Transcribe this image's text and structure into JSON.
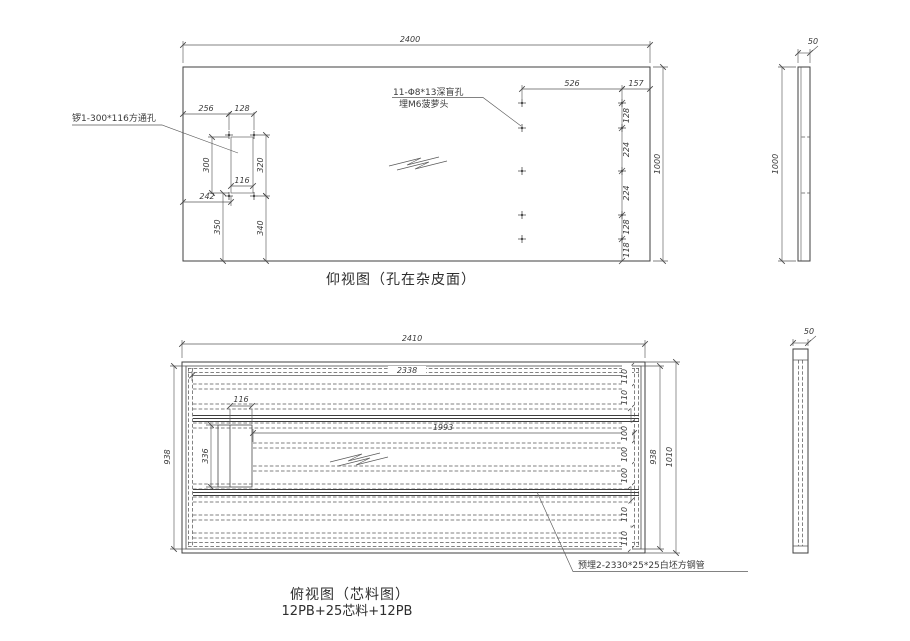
{
  "top_view": {
    "caption": "仰视图（孔在杂皮面）",
    "note_square_hole": "锣1-300*116方通孔",
    "note_holes_1": "11-Φ8*13深盲孔",
    "note_holes_2": "埋M6菠萝头",
    "dim_overall_width": "2400",
    "dim_overall_height": "1000",
    "dim_256": "256",
    "dim_128": "128",
    "dim_300": "300",
    "dim_320": "320",
    "dim_116": "116",
    "dim_242": "242",
    "dim_350": "350",
    "dim_340": "340",
    "dim_526": "526",
    "dim_157": "157",
    "chain": [
      "128",
      "224",
      "224",
      "128",
      "118"
    ],
    "side_thickness": "50",
    "side_height": "1000"
  },
  "bottom_view": {
    "caption_1": "俯视图（芯料图）",
    "caption_2": "12PB+25芯料+12PB",
    "note_tube": "预埋2-2330*25*25白坯方钢管",
    "dim_overall_width": "2410",
    "dim_rail_long": "2338",
    "dim_rail_mid": "1993",
    "dim_block_width": "116",
    "dim_block_height": "336",
    "dim_height_left": "938",
    "dim_height_right": "938",
    "dim_overall_height": "1010",
    "chain": [
      "110",
      "110",
      "100",
      "100",
      "100",
      "110",
      "110"
    ],
    "side_thickness": "50"
  }
}
